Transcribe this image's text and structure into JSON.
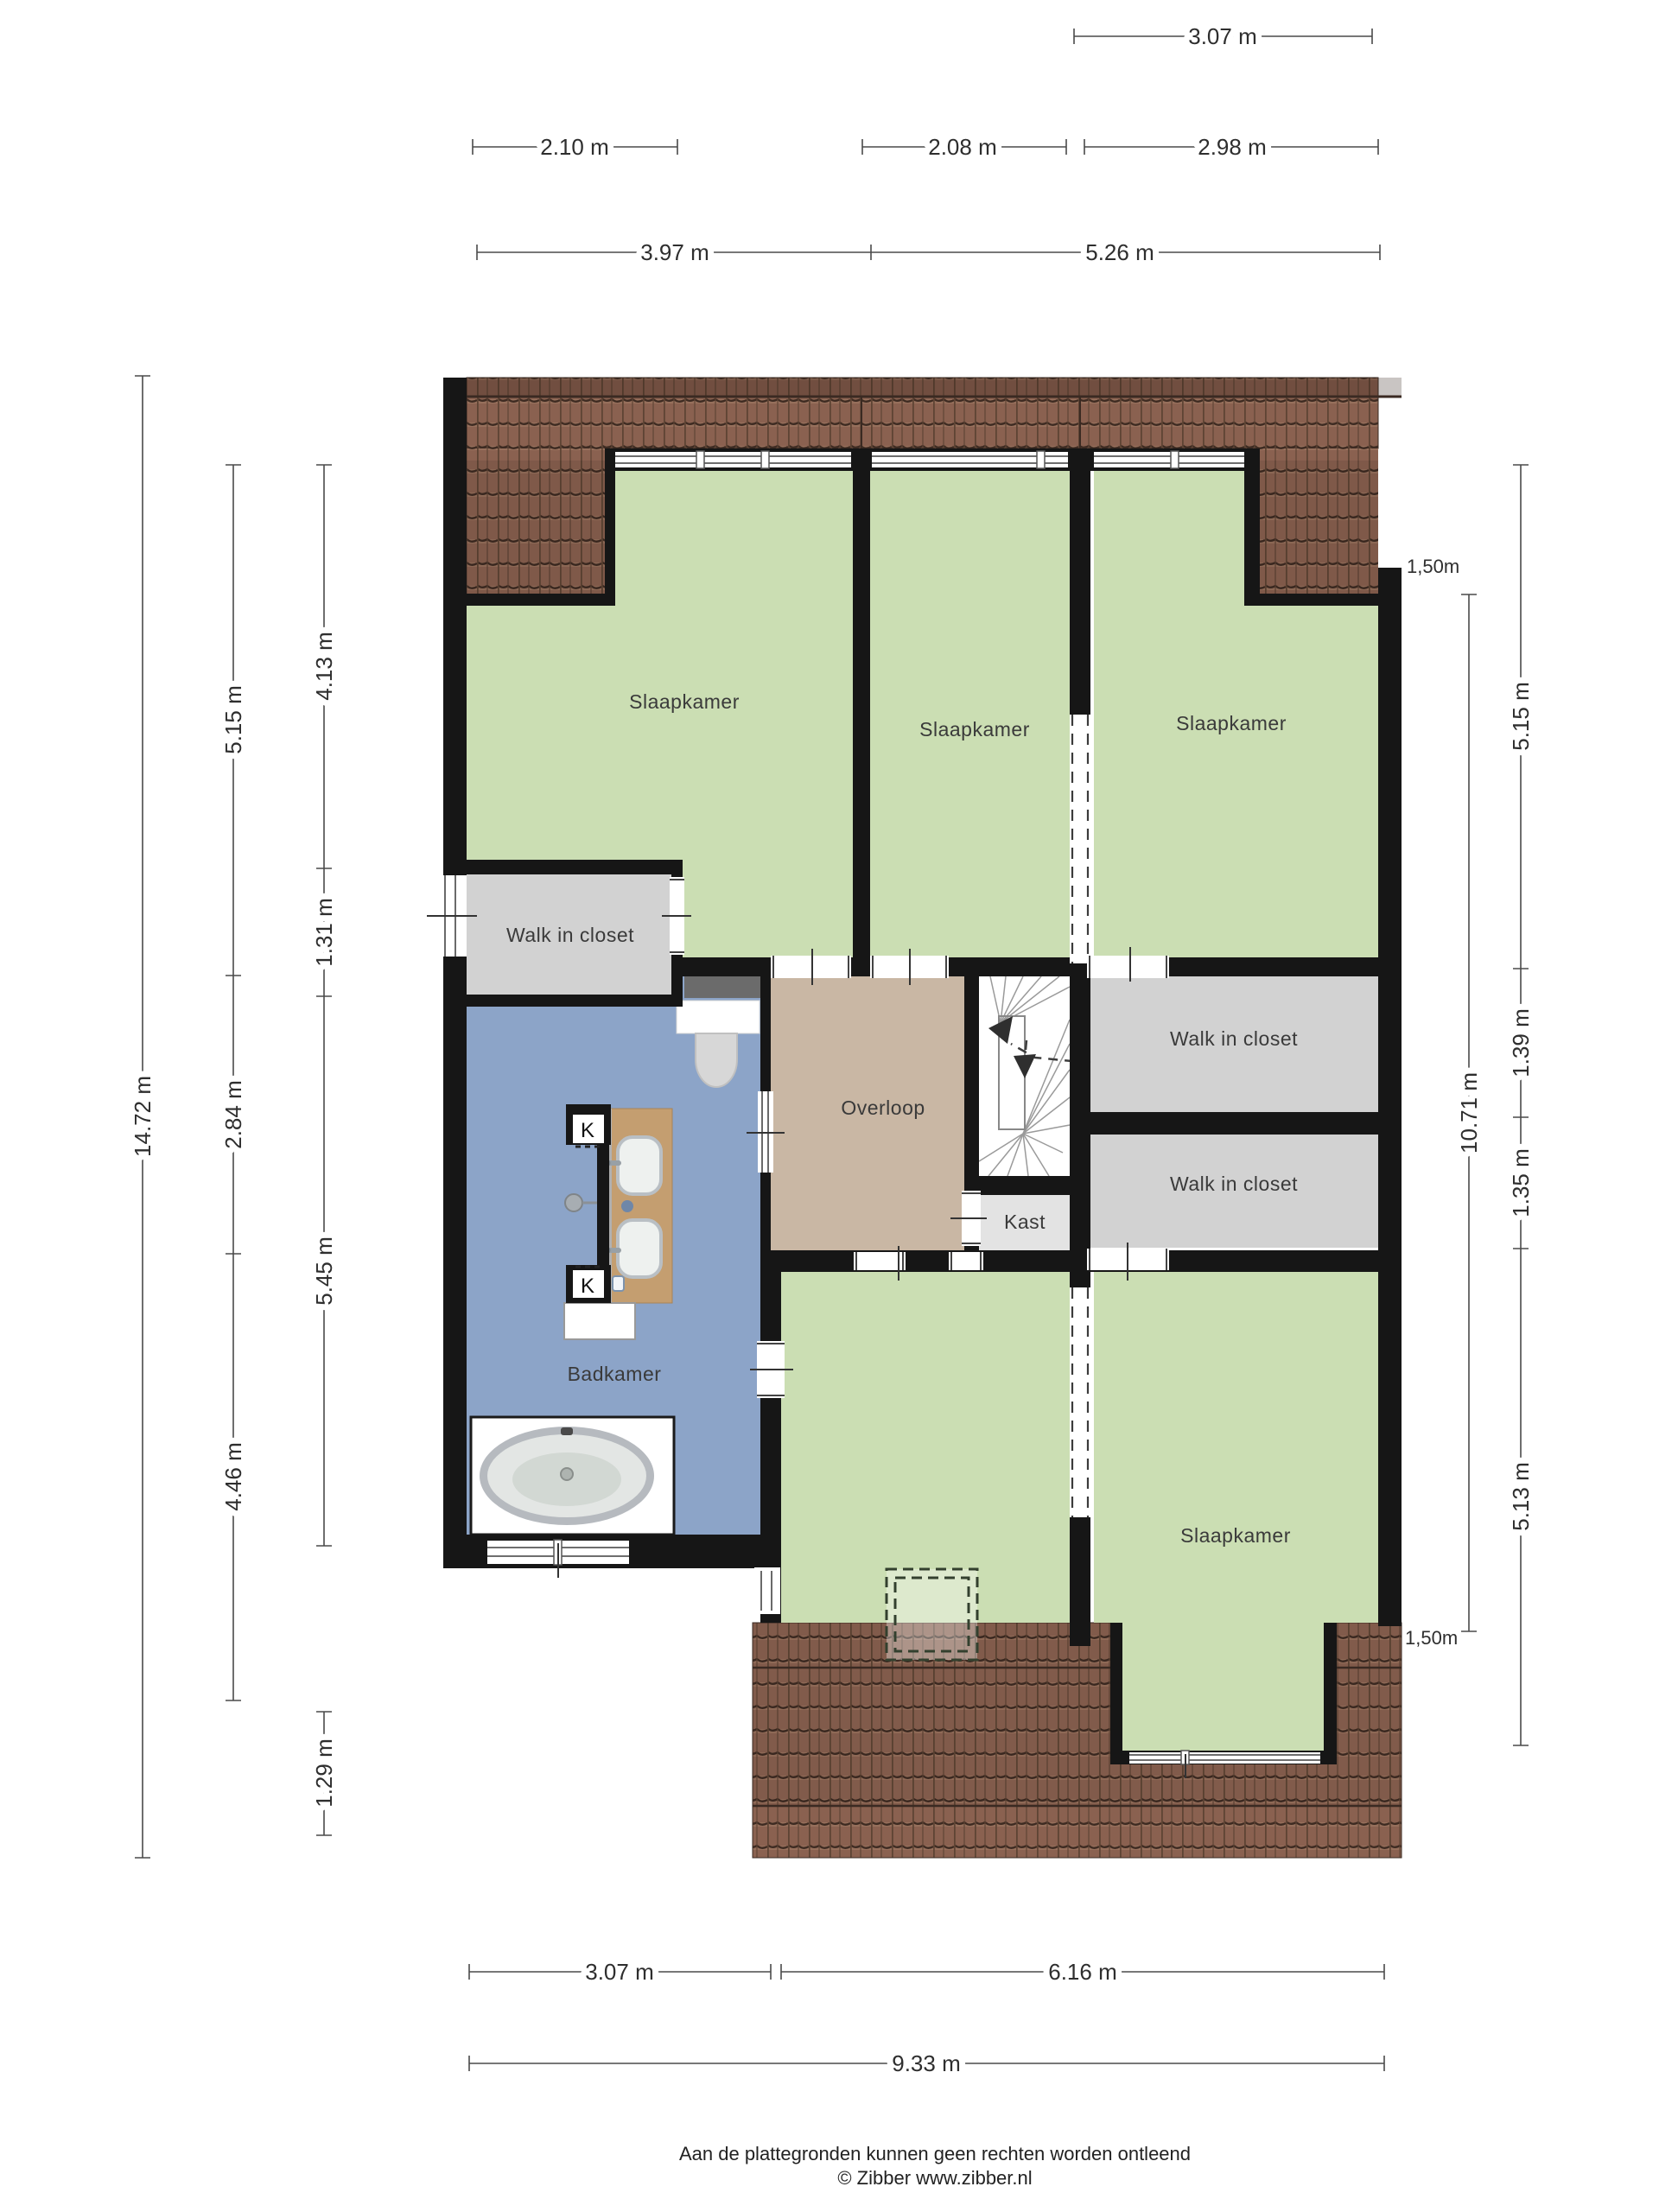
{
  "rooms": {
    "slaapkamer_tl": "Slaapkamer",
    "slaapkamer_tm": "Slaapkamer",
    "slaapkamer_tr": "Slaapkamer",
    "slaapkamer_br": "Slaapkamer",
    "wic_left": "Walk in closet",
    "wic_r1": "Walk in closet",
    "wic_r2": "Walk in closet",
    "overloop": "Overloop",
    "kast": "Kast",
    "badkamer": "Badkamer",
    "shaft": "K"
  },
  "dims": {
    "d307a": "3.07 m",
    "d210": "2.10 m",
    "d208": "2.08 m",
    "d298": "2.98 m",
    "d397": "3.97 m",
    "d526": "5.26 m",
    "d1472": "14.72 m",
    "d515l": "5.15 m",
    "d284": "2.84 m",
    "d446": "4.46 m",
    "d413": "4.13 m",
    "d131": "1.31 m",
    "d545": "5.45 m",
    "d129": "1.29 m",
    "d1071": "10.71 m",
    "d515r": "5.15 m",
    "d139": "1.39 m",
    "d135": "1.35 m",
    "d513": "5.13 m",
    "d307b": "3.07 m",
    "d616": "6.16 m",
    "d933": "9.33 m",
    "knee_top": "1,50m",
    "knee_bottom": "1,50m"
  },
  "footer": {
    "line1": "Aan de plattegronden kunnen geen rechten worden ontleend",
    "line2": "© Zibber www.zibber.nl"
  },
  "colors": {
    "wall": "#161616",
    "bedroom_green": "#cbdeb3",
    "closet_gray": "#d2d2d2",
    "kast_gray": "#e3e3e3",
    "hall_tan": "#c9b7a4",
    "bath_blue": "#8ca4c8",
    "roof_brown": "#8a6150",
    "roof_line": "#3a2a22",
    "wood": "#c49e70"
  }
}
